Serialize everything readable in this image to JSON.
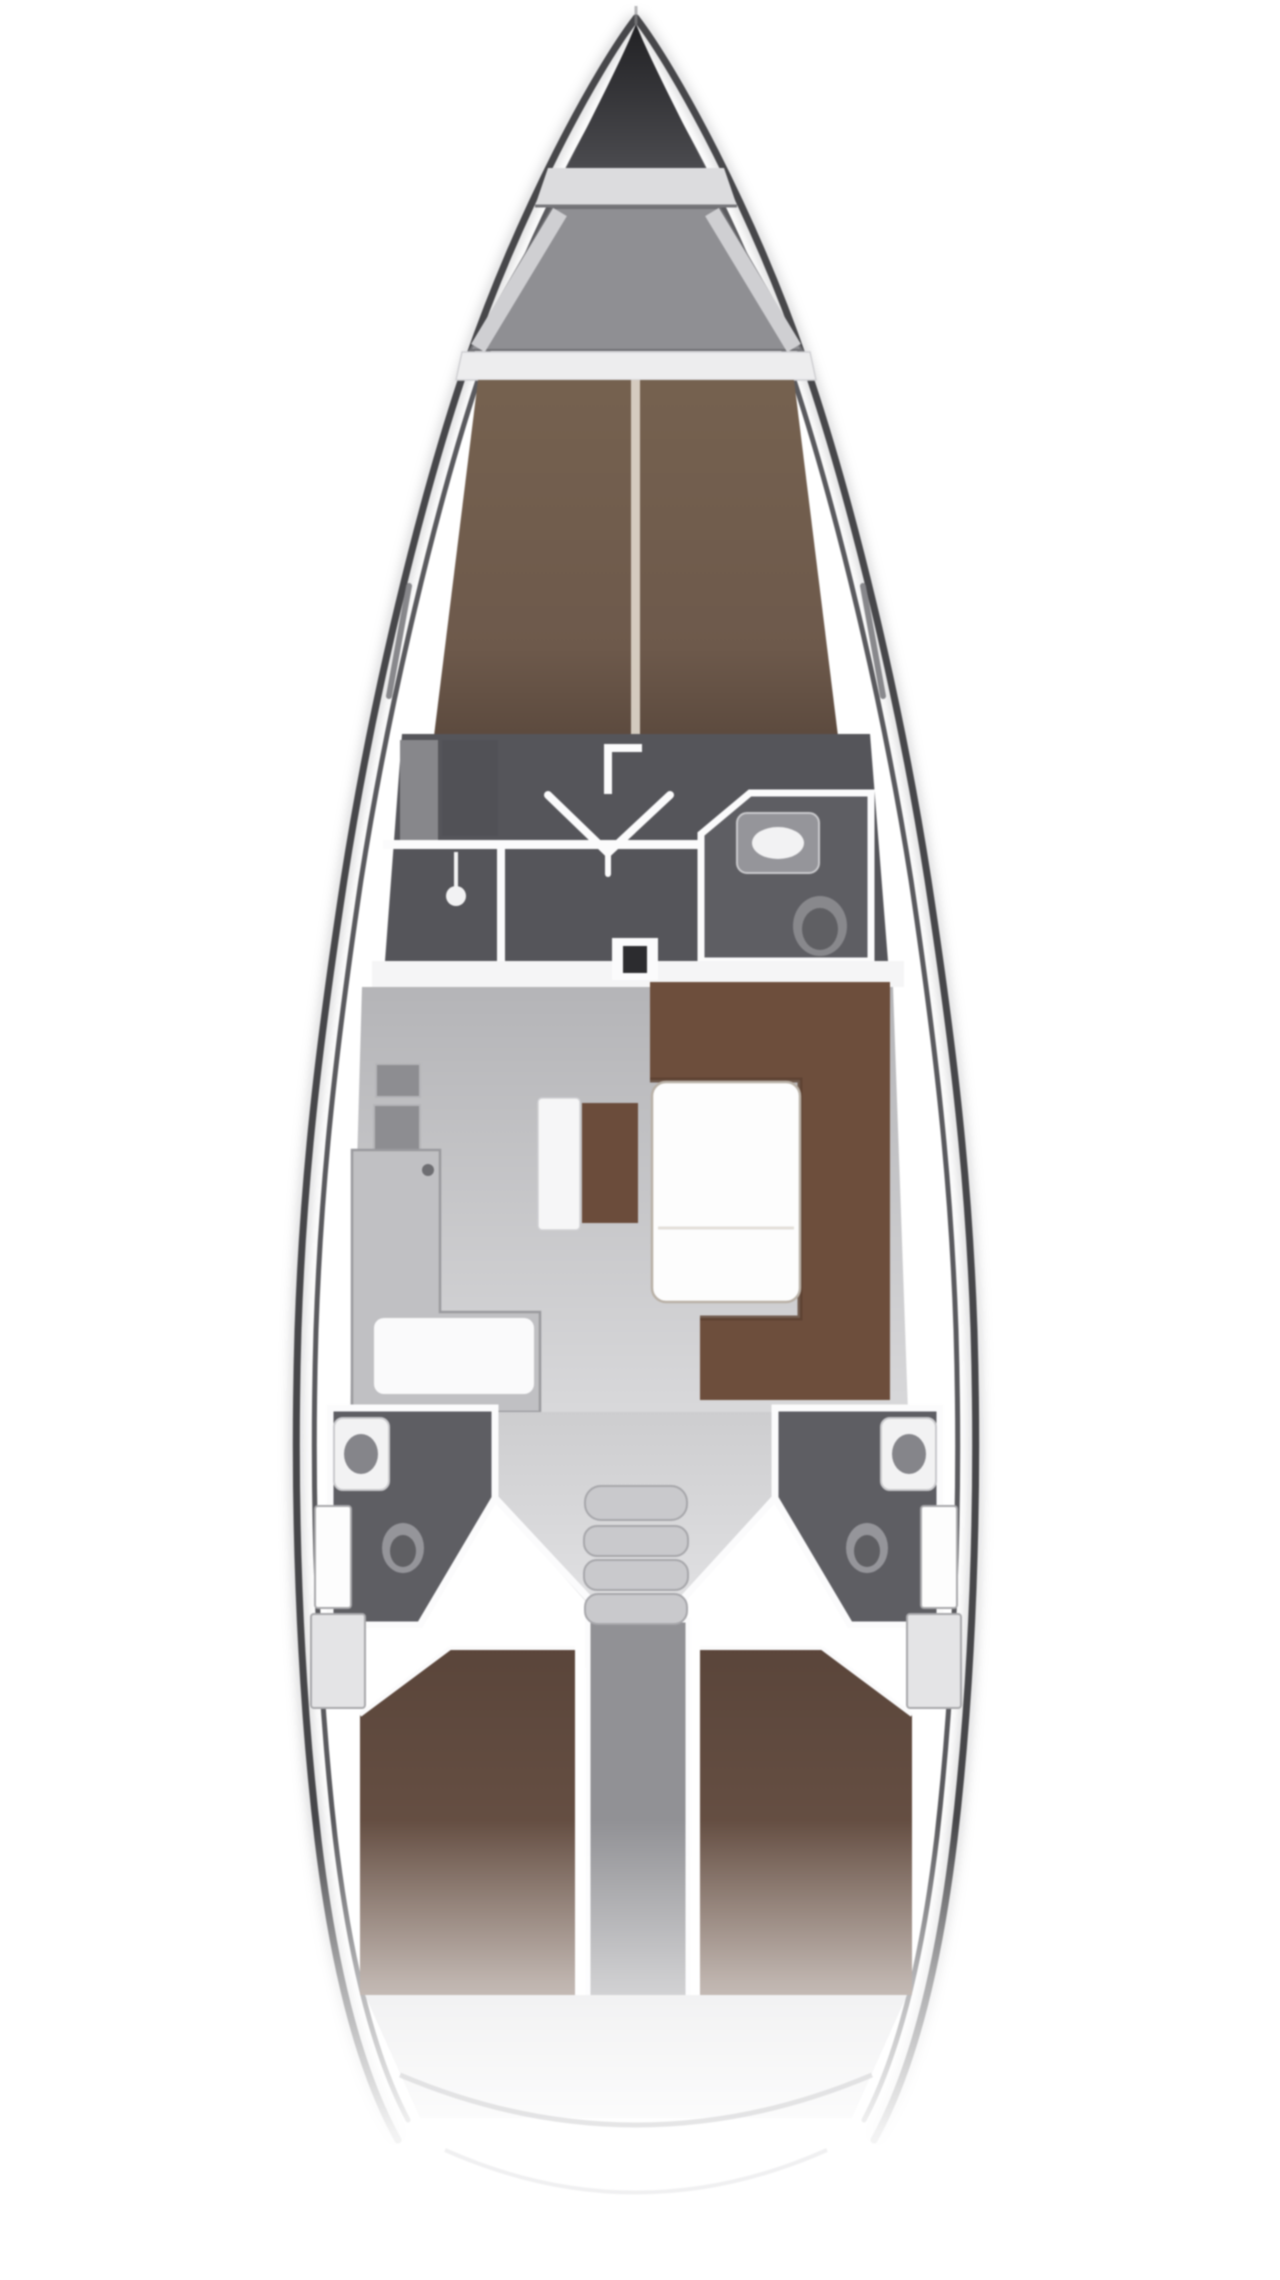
{
  "diagram": {
    "type": "yacht-interior-floor-plan",
    "view": "top-down",
    "orientation": "bow-up"
  },
  "counts": {
    "companionway_steps": 4,
    "aft_cabins": 2,
    "aft_heads": 2,
    "forward_heads": 1,
    "salon_tables": 1
  },
  "regions": {
    "bow": "anchor-locker",
    "bulkhead_fore": "bow-bulkhead",
    "foredeck": "foredeck-well",
    "pillow_band": "forward-berth-head",
    "forward_berth": "forward-cabin-v-berth",
    "midship": "forward-cabin-floor",
    "shower": "shower-compartment",
    "forward_head": "forward-head-bathroom",
    "mast": "mast-step",
    "galley": "galley-l-counter",
    "salon": "salon-floor",
    "settee": "u-shaped-settee",
    "table": "salon-table",
    "bench": "centerline-bench",
    "stairs": "companionway-stairs",
    "port_head": "port-aft-head",
    "stb_head": "starboard-aft-head",
    "port_cabin": "port-aft-cabin-berth",
    "stb_cabin": "starboard-aft-cabin-berth",
    "engine": "engine-compartment",
    "stern": "stern-transom"
  },
  "colors": {
    "page_bg": "#ffffff",
    "hull_line": "#47474a",
    "hull_inner_line": "#5a5a5e",
    "hull_shadow": "#aaaaad",
    "bow_top": "#212124",
    "bow_bottom": "#4b4b4f",
    "bow_stem": "#8a8a8d",
    "bulkhead_light": "#dcdcde",
    "bulkhead_edge": "#76767a",
    "foredeck_gray": "#8f8f93",
    "foredeck_rail": "#cfcfd2",
    "foredeck_outline": "#6f6f73",
    "pillow_white": "#ededee",
    "pillow_edge": "#d0d0d3",
    "forward_berth_top": "#75614f",
    "forward_berth_mid": "#6d594b",
    "forward_berth_foot": "#5c4a3e",
    "berth_centerline": "#ddd5c9",
    "midship_dark": "#55555a",
    "locker_panel": "#87878b",
    "wardrobe_dark": "#515156",
    "wall_white": "#fbfbfc",
    "head_dark": "#5e5e63",
    "fixture_gray": "#95959a",
    "fixture_white": "#f2f2f3",
    "fixture_rim": "#c9c9cc",
    "toilet_outer": "#88888c",
    "toilet_inner": "#5f5f63",
    "sink_bowl": "#85858a",
    "mast_dark": "#2c2c2f",
    "bulkhead_band": "#f5f5f6",
    "salon_floor_top": "#b4b4b7",
    "salon_floor_bottom": "#d8d8da",
    "cabinet_gray": "#8d8d91",
    "cabinet_edge": "#b5b5b8",
    "galley_counter": "#c0c0c3",
    "galley_edge": "#9a9a9e",
    "worktop_white": "#fafafb",
    "faucet_dark": "#6e6e72",
    "settee_brown": "#6d4e3c",
    "settee_brown_dark": "#5a4030",
    "table_white": "#fdfdfd",
    "table_outline": "#b9b1a7",
    "table_seam": "#e4e0da",
    "bench_white": "#f6f6f7",
    "bench_brown": "#6b4c3b",
    "funnel_top": "#cdcdcf",
    "funnel_bottom": "#e2e2e4",
    "stairs_step": "#c9c9cc",
    "stairs_gap": "#a7a7ab",
    "engine_gray": "#919195",
    "aft_berth_top": "#5a453a",
    "aft_berth_bottom": "#6f574a",
    "aft_locker_light": "#e4e4e6",
    "aft_locker_white": "#fdfdfd",
    "aft_locker_edge": "#a8a8ab",
    "aft_floor": "#dfdfe1",
    "transom_line_1": "#cfcfd2",
    "transom_line_2": "#dedee0",
    "window_slit": "#7d7d81"
  }
}
